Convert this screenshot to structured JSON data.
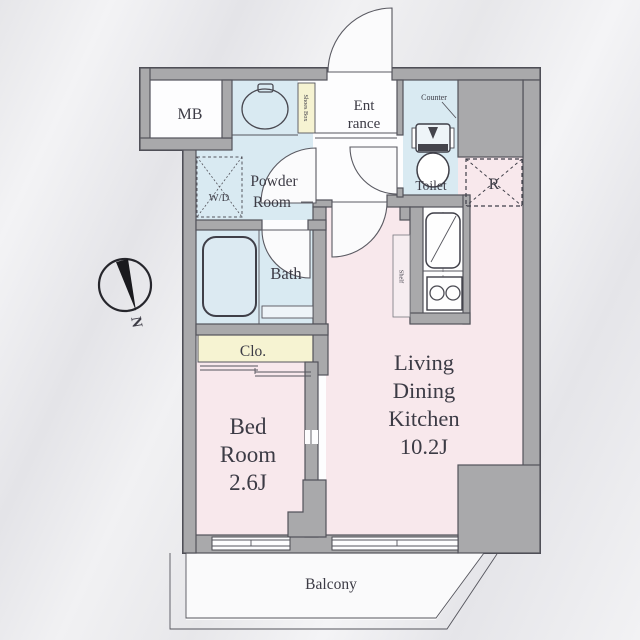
{
  "plan": {
    "rooms": {
      "mb": "MB",
      "powder_line1": "Powder",
      "powder_line2": "Room",
      "wd": "W/D",
      "entrance_line1": "Ent",
      "entrance_line2": "rance",
      "shoes_box": "Shoes Box",
      "toilet": "Toilet",
      "toilet_counter": "Counter",
      "bath": "Bath",
      "closet": "Clo.",
      "bed_line1": "Bed",
      "bed_line2": "Room",
      "bed_size": "2.6J",
      "ldk_line1": "Living",
      "ldk_line2": "Dining",
      "ldk_line3": "Kitchen",
      "ldk_size": "10.2J",
      "shelf": "Shelf",
      "refrigerator": "R",
      "balcony": "Balcony"
    },
    "compass": {
      "north": "N"
    },
    "colors": {
      "room_pink": "#f8e8ec",
      "room_blue": "#d9eaf2",
      "room_yellow": "#f6f3d2",
      "wall_gray": "#a9a9ab",
      "line": "#4a4a52"
    }
  }
}
